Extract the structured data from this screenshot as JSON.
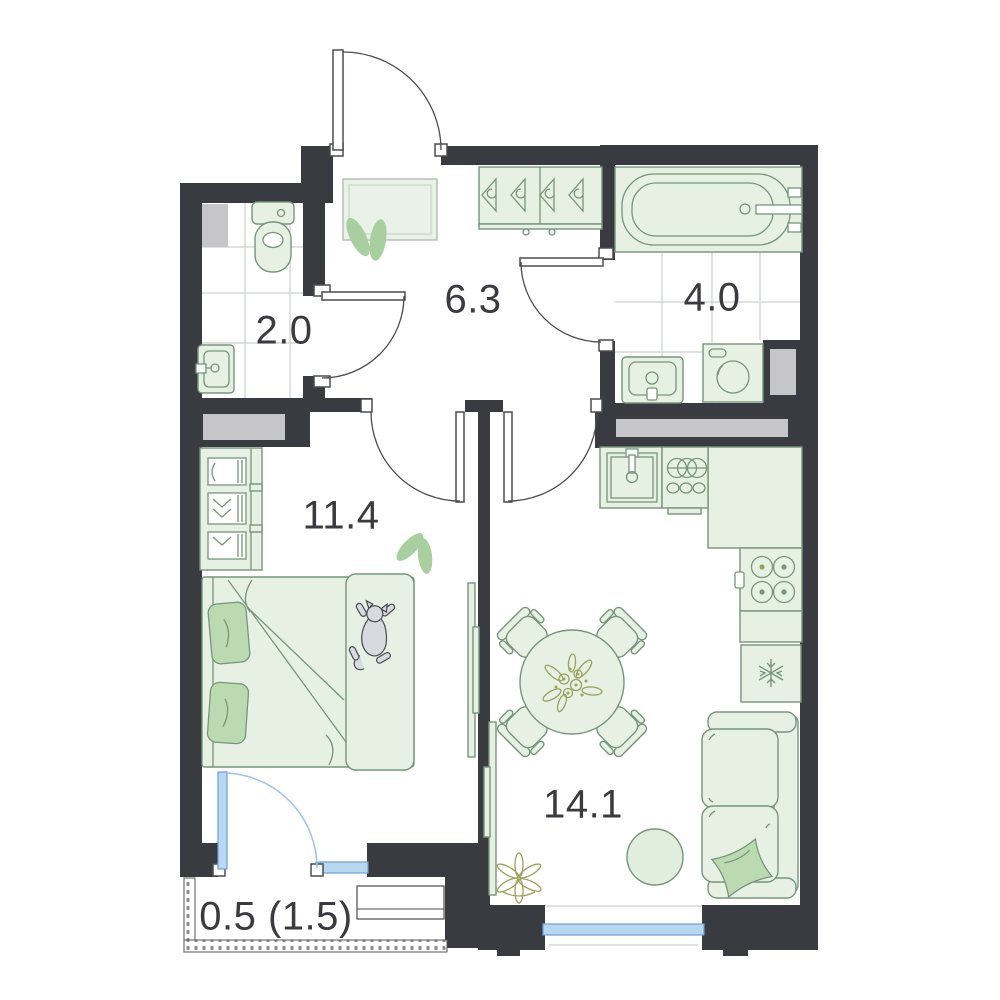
{
  "title": "apartment-floor-plan",
  "rooms": [
    {
      "name": "toilet",
      "area_label": "2.0"
    },
    {
      "name": "hallway",
      "area_label": "6.3"
    },
    {
      "name": "bathroom",
      "area_label": "4.0"
    },
    {
      "name": "bedroom",
      "area_label": "11.4"
    },
    {
      "name": "living-kitchen",
      "area_label": "14.1"
    },
    {
      "name": "balcony",
      "area_label": "0.5 (1.5)"
    }
  ],
  "icons": [
    "entrance-door",
    "interior-door",
    "balcony-door",
    "window",
    "toilet",
    "washbasin",
    "bathtub",
    "washing-machine",
    "coat-rack-hangers",
    "entry-mat",
    "plant-leaves",
    "wardrobe",
    "double-bed",
    "pillows",
    "cat",
    "tv",
    "kitchen-sink",
    "hob-dishes",
    "cooktop-4-burner",
    "fridge-snowflake",
    "dining-table",
    "chairs",
    "flower-bouquet",
    "sofa",
    "sofa-pillow",
    "round-rug",
    "corner-plant",
    "balcony-railing",
    "balcony-bench",
    "ventilation-shaft"
  ],
  "colors": {
    "wall": "#3a3a41",
    "shaft": "#c6c6c9",
    "fixture_fill": "#e7f1e3",
    "fixture_stroke": "#76957c",
    "pillow": "#bcdab1",
    "leaf": "#a9cfa0",
    "window_fill": "#b8d7f2",
    "window_stroke": "#6d9fce",
    "window_arc": "#9cc2e8",
    "line": "#4b4b52",
    "tile": "#ccd2cc",
    "olive": "#9aa25c",
    "label": "#3a3a40",
    "cat": "#d7dade",
    "rug": "#e2eedd"
  }
}
